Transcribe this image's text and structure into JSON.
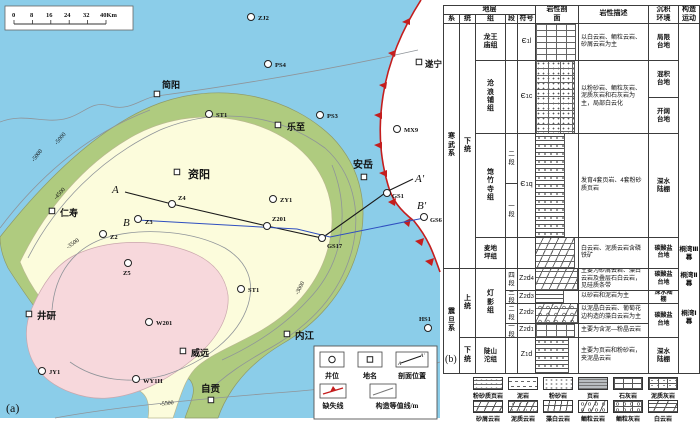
{
  "map": {
    "panel_label": "(a)",
    "scalebar": [
      "0",
      "8",
      "16",
      "24",
      "32",
      "40Km"
    ],
    "towns": [
      "简阳",
      "遂宁",
      "乐至",
      "资阳",
      "仁寿",
      "安岳",
      "井研",
      "内江",
      "威远",
      "自贡"
    ],
    "wells": [
      "ZJ2",
      "PS4",
      "PS3",
      "ST1",
      "MX9",
      "ZY1",
      "Z4",
      "Z3",
      "Z201",
      "Z2",
      "Z5",
      "ST1",
      "W201",
      "JY1",
      "WY1H",
      "HS1",
      "GS17",
      "GS1",
      "GS6"
    ],
    "sections": [
      "A",
      "A′",
      "B",
      "B′"
    ],
    "contours": [
      "-5500",
      "-5000",
      "-5000",
      "-4500",
      "-3500",
      "-3000"
    ],
    "legend": [
      "井位",
      "地名",
      "剖面位置",
      "缺失线",
      "构造等值线/m"
    ],
    "colors": {
      "water": "#8bcde9",
      "slope": "#afcb7f",
      "mid": "#fcfcdc",
      "high": "#f7d8dc",
      "fault": "#c41e1e",
      "section_b": "#2f4fc0"
    }
  },
  "strat": {
    "panel_label": "(b)",
    "header": {
      "strata": "地层",
      "system": "系",
      "series": "统",
      "formation": "组",
      "member": "段",
      "symbol": "符号",
      "profile": "岩性剖面",
      "desc": "岩性描述",
      "env": "沉积环境",
      "tect": "构造运动"
    },
    "systems": [
      "寒武系",
      "震旦系"
    ],
    "series_labels": [
      "下统",
      "上统",
      "下统"
    ],
    "formations": [
      "龙王庙组",
      "沧浪铺组",
      "筇竹寺组",
      "麦地坪组",
      "灯影组",
      "陡山沱组"
    ],
    "members": [
      "二段",
      "一段",
      "四段",
      "三段",
      "二段",
      "一段"
    ],
    "syms": [
      [
        "Є",
        "1",
        "l",
        ""
      ],
      [
        "Є",
        "1",
        "c",
        ""
      ],
      [
        "Є",
        "1",
        "q",
        ""
      ],
      [
        "Z",
        "2",
        "d",
        "4"
      ],
      [
        "Z",
        "2",
        "d",
        "3"
      ],
      [
        "Z",
        "2",
        "d",
        "2"
      ],
      [
        "Z",
        "2",
        "d",
        "1"
      ],
      [
        "Z",
        "1",
        "d",
        ""
      ]
    ],
    "descs": [
      "以白云岩、鲕粒云岩、砂屑云岩为主",
      "以粉砂岩、鲕粒灰岩、泥质灰岩和石灰岩为主，局部白云化",
      "发育4套页岩、4套粉砂质页岩",
      "白云岩、泥质云岩含磷铁矿",
      "主要为砂屑云岩、藻白云岩及叠层石白云岩，见硅质条带",
      "以砂岩和泥岩为主",
      "以泥晶白云岩、葡萄花边构造的藻白云岩为主",
      "主要为含泥—粉晶云岩",
      "主要为页岩和粉砂岩，夹泥晶云岩"
    ],
    "envs": [
      "局限台地",
      "混积台地",
      "开阔台地",
      "深水陆棚",
      "碳酸盐台地",
      "碳酸盐台地",
      "深水陆棚",
      "碳酸盐台地",
      "深水陆棚"
    ],
    "tectonics": [
      "桐湾Ⅲ幕",
      "桐湾Ⅱ幕",
      "桐湾Ⅰ幕"
    ],
    "litho": [
      "粉砂质页岩",
      "泥岩",
      "粉砂岩",
      "页岩",
      "石灰岩",
      "泥质灰岩",
      "砂屑云岩",
      "泥质云岩",
      "藻白云岩",
      "鲕粒云岩",
      "鲕粒灰岩",
      "白云岩"
    ]
  }
}
